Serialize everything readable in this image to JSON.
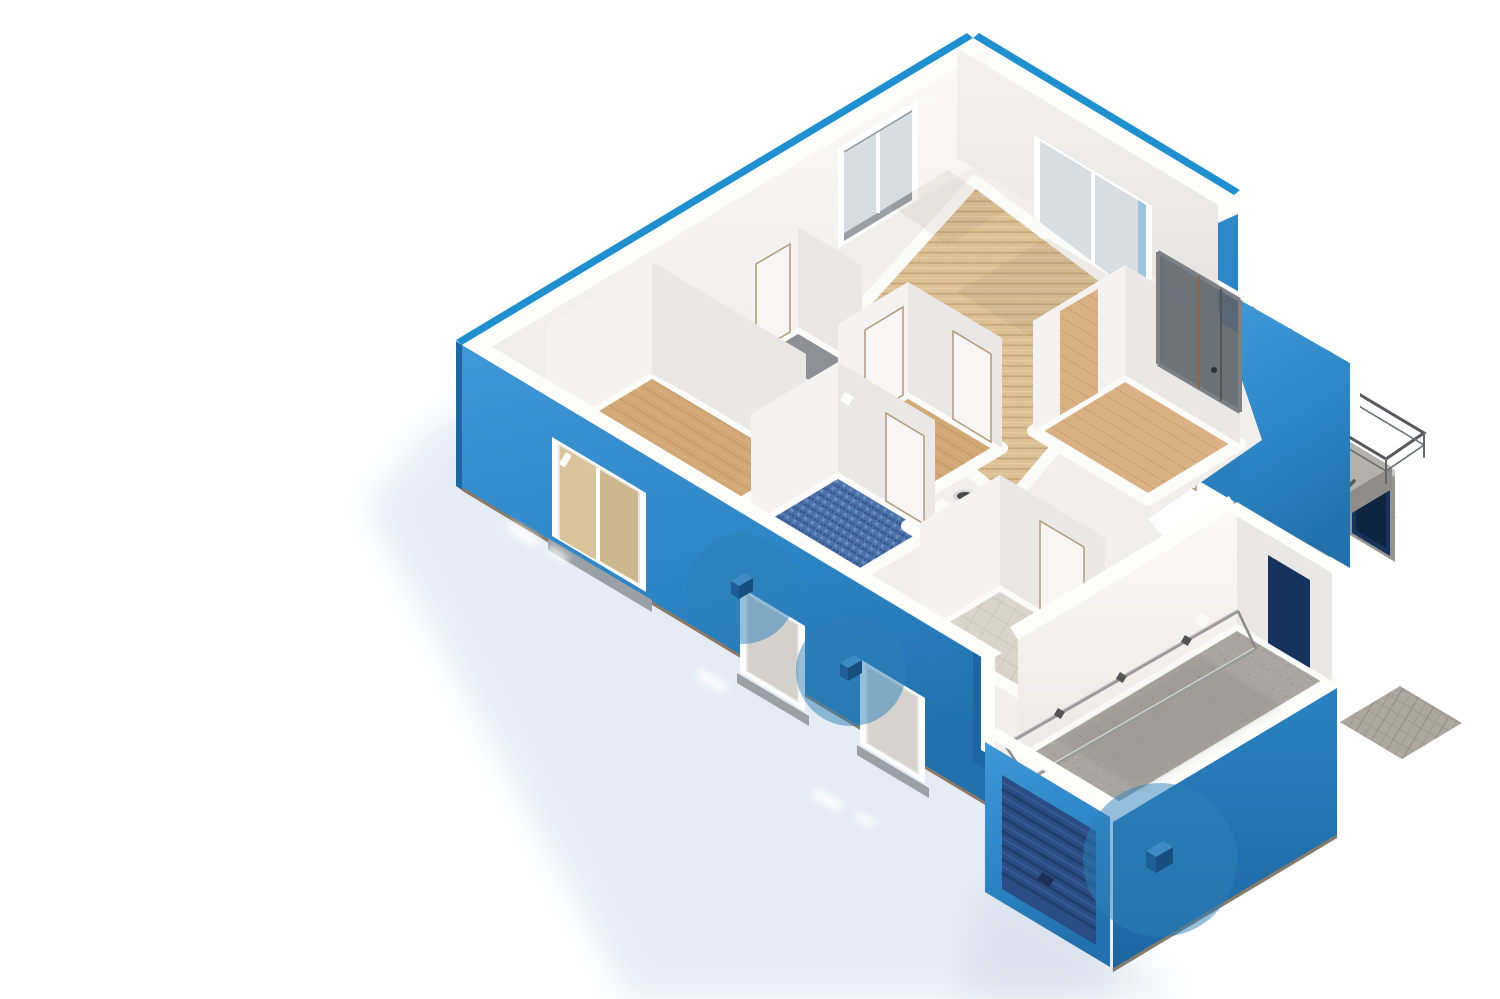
{
  "scene": {
    "kind": "isometric 3D cutaway floor plan render",
    "background": "#ffffff",
    "view": "top-down oblique, no visible text labels"
  },
  "palette": {
    "roof_edge_blue": "#1f8fd0",
    "wall_blue_light": "#3f97d6",
    "wall_blue": "#2e86c6",
    "wall_blue_dark": "#1d66a2",
    "roller_door_navy": "#2b4d86",
    "roller_slat_dark": "#223e6b",
    "door_navy": "#16335e",
    "interior_white": "#f6f4f2",
    "parquet_tan": "#dcbe93",
    "plank_wood": "#d2a876",
    "mosaic_blue": "#4a6fa8",
    "tile_beige": "#d9d3c9",
    "carpet_gray": "#8d9197",
    "concrete_gray": "#a8a5a1",
    "stair_concrete": "#b6b3af",
    "pit_dark": "#666462",
    "metal_railing": "#55585c",
    "marker_blue": "#2d7fb8",
    "sensor_cube": "#1d5e97",
    "shadow_tint": "#dee6f2"
  },
  "markers": [
    {
      "id": "sensor-marker-1",
      "icon": "sensor-cube-icon",
      "cx": "742",
      "cy": "589",
      "r": "55"
    },
    {
      "id": "sensor-marker-2",
      "icon": "sensor-cube-icon",
      "cx": "851",
      "cy": "671",
      "r": "55"
    },
    {
      "id": "sensor-marker-3",
      "icon": "sensor-cube-icon",
      "cx": "1160",
      "cy": "860",
      "r": "77"
    }
  ],
  "rooms": [
    {
      "name": "living-room",
      "floor": "herringbone-parquet"
    },
    {
      "name": "corner-room",
      "floor": "pale"
    },
    {
      "name": "closet",
      "floor": "gray-carpet"
    },
    {
      "name": "bedroom",
      "floor": "wood-plank"
    },
    {
      "name": "hallway",
      "floor": "wood-plank"
    },
    {
      "name": "bathroom",
      "floor": "blue-mosaic"
    },
    {
      "name": "tech-closet",
      "floor": "pale",
      "fixture": "water-heater-cylinder"
    },
    {
      "name": "entry-hall",
      "floor": "beige-tile"
    },
    {
      "name": "right-room",
      "floor": "wood-plank"
    },
    {
      "name": "garage",
      "floor": "concrete"
    }
  ],
  "features": [
    "balcony-with-glass-railing",
    "external-concrete-stairs-with-metal-railings",
    "stair-landing-with-navy-entrance-door",
    "garage-roller-door",
    "garage-ceiling-track-rails",
    "ground-shadow-with-light-streaks"
  ],
  "counts": {
    "sensor_markers": 3,
    "front_wall_windows": 3,
    "top_wall_windows": 2,
    "white_interior_doors": 6
  }
}
